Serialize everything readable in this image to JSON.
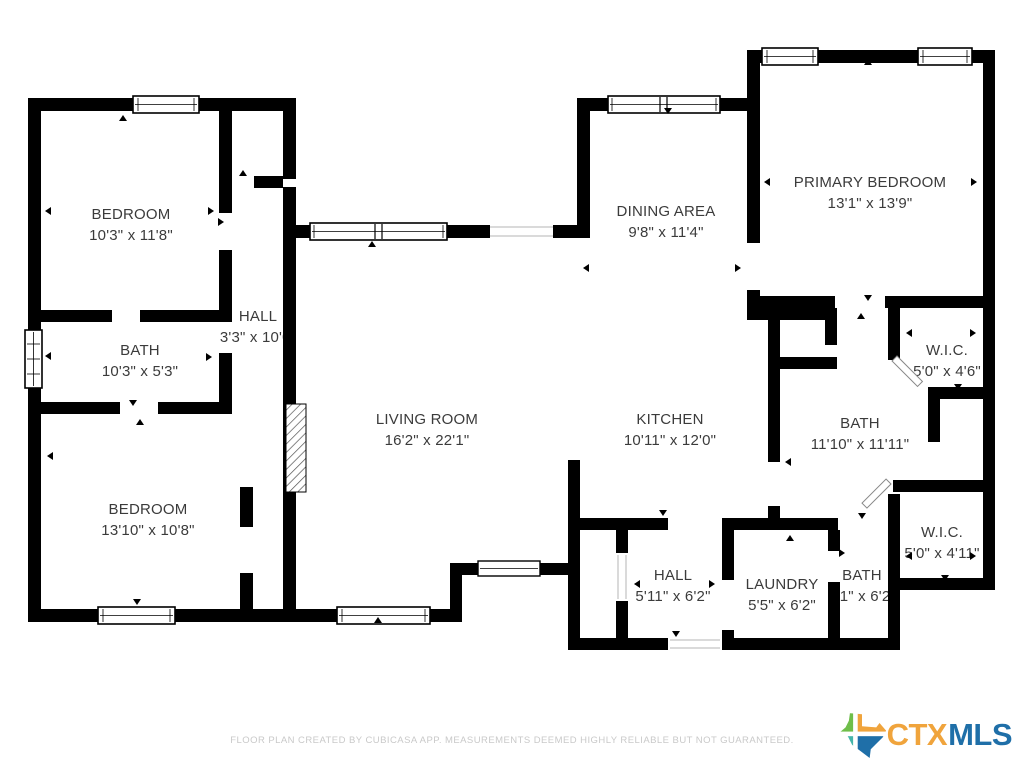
{
  "rooms": [
    {
      "id": "bedroom-top-left",
      "name": "BEDROOM",
      "dims": "10'3\" x 11'8\""
    },
    {
      "id": "hall-upper",
      "name": "HALL",
      "dims": "3'3\" x 10'0\""
    },
    {
      "id": "bath-left",
      "name": "BATH",
      "dims": "10'3\" x 5'3\""
    },
    {
      "id": "bedroom-bottom-left",
      "name": "BEDROOM",
      "dims": "13'10\" x 10'8\""
    },
    {
      "id": "living-room",
      "name": "LIVING ROOM",
      "dims": "16'2\" x 22'1\""
    },
    {
      "id": "dining-area",
      "name": "DINING AREA",
      "dims": "9'8\" x 11'4\""
    },
    {
      "id": "kitchen",
      "name": "KITCHEN",
      "dims": "10'11\" x 12'0\""
    },
    {
      "id": "primary-bedroom",
      "name": "PRIMARY BEDROOM",
      "dims": "13'1\" x 13'9\""
    },
    {
      "id": "wic-top",
      "name": "W.I.C.",
      "dims": "5'0\" x 4'6\""
    },
    {
      "id": "bath-right",
      "name": "BATH",
      "dims": "11'10\" x 11'11\""
    },
    {
      "id": "wic-bottom",
      "name": "W.I.C.",
      "dims": "5'0\" x 4'11\""
    },
    {
      "id": "hall-bottom",
      "name": "HALL",
      "dims": "5'11\" x 6'2\""
    },
    {
      "id": "laundry",
      "name": "LAUNDRY",
      "dims": "5'5\" x 6'2\""
    },
    {
      "id": "bath-bottom",
      "name": "BATH",
      "dims": "3'1\" x 6'2\""
    }
  ],
  "footer": {
    "disclaimer": "FLOOR PLAN CREATED BY CUBICASA APP. MEASUREMENTS DEEMED HIGHLY RELIABLE BUT NOT GUARANTEED."
  },
  "logo": {
    "ctx": "CTX",
    "mls": "MLS"
  },
  "colors": {
    "wall": "#000000",
    "label_text": "#3b3b3b",
    "muted_text": "#c9c9c9",
    "logo_ctx": "#F0A43C",
    "logo_mls": "#1F6FA8",
    "texas_green": "#6FBE4A",
    "texas_orange": "#F0A43C",
    "texas_teal": "#45B5AA",
    "texas_blue": "#1F6FA8"
  }
}
